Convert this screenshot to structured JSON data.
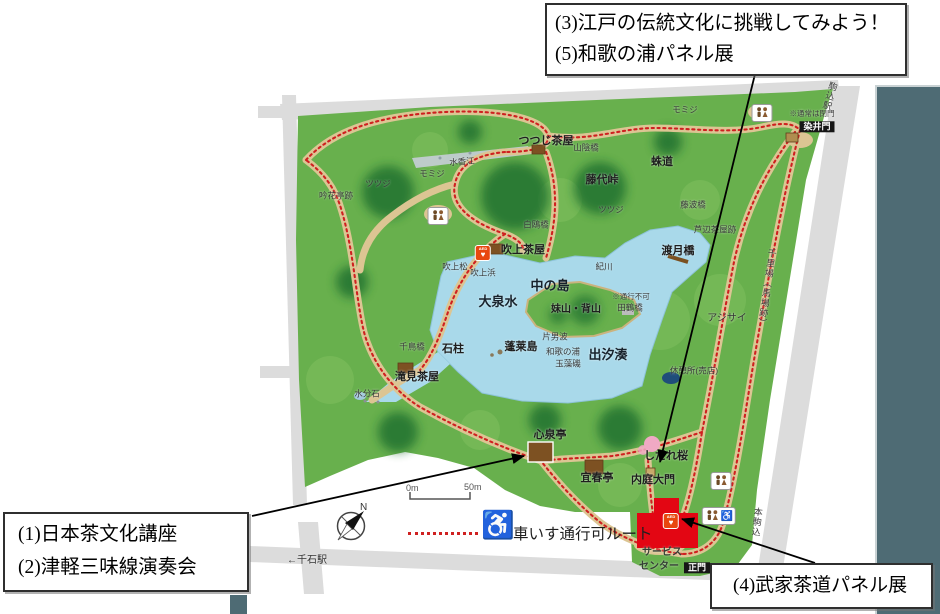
{
  "callouts": {
    "top": {
      "line1": "(3)江戸の伝統文化に挑戦してみよう！",
      "line2": "(5)和歌の浦パネル展"
    },
    "bottom_left": {
      "line1": "(1)日本茶文化講座",
      "line2": "(2)津軽三味線演奏会"
    },
    "bottom_right": {
      "line1": "(4)武家茶道パネル展"
    }
  },
  "legend": {
    "route_label": "車いす通行可ルート",
    "scale_start": "0m",
    "scale_end": "50m",
    "compass_north": "N"
  },
  "colors": {
    "park_green": "#68b04d",
    "forest_dark_green": "#1d6e2d",
    "lake_blue": "#a9d9ea",
    "path_tan": "#dcc593",
    "route_red": "#cf2020",
    "road_gray": "#dcdcdc",
    "service_center_red": "#e30613",
    "background_panel_slate": "#4e6b74",
    "gate_label_bg": "#161616"
  },
  "icon_glyphs": [
    {
      "name": "toilet-icon",
      "glyph": "🚻"
    },
    {
      "name": "toilet-accessible-icon",
      "glyph": "🚻♿"
    },
    {
      "name": "aed-icon",
      "glyph": "AED ♥"
    },
    {
      "name": "wheelchair-icon",
      "glyph": "♿"
    },
    {
      "name": "compass-icon",
      "glyph": "N"
    }
  ],
  "map": {
    "labels": [
      {
        "t": "つつじ茶屋",
        "x": 546,
        "y": 142,
        "s": "l"
      },
      {
        "t": "山陰橋",
        "x": 586,
        "y": 148,
        "s": "s"
      },
      {
        "t": "蛛道",
        "x": 662,
        "y": 163,
        "s": "l"
      },
      {
        "t": "藤代峠",
        "x": 602,
        "y": 181,
        "s": "l"
      },
      {
        "t": "ツツジ",
        "x": 611,
        "y": 210,
        "s": "s"
      },
      {
        "t": "白鴎橋",
        "x": 536,
        "y": 225,
        "s": "s"
      },
      {
        "t": "モミジ",
        "x": 432,
        "y": 174,
        "s": "s"
      },
      {
        "t": "モミジ",
        "x": 685,
        "y": 110,
        "s": "s"
      },
      {
        "t": "水香江",
        "x": 462,
        "y": 162,
        "s": "s",
        "r": -4
      },
      {
        "t": "ツツジ",
        "x": 378,
        "y": 184,
        "s": "s"
      },
      {
        "t": "吟花亭跡",
        "x": 336,
        "y": 196,
        "s": "s"
      },
      {
        "t": "吹上茶屋",
        "x": 523,
        "y": 251,
        "s": "l"
      },
      {
        "t": "吹上松",
        "x": 455,
        "y": 267,
        "s": "s"
      },
      {
        "t": "吹上浜",
        "x": 483,
        "y": 273,
        "s": "s"
      },
      {
        "t": "紀川",
        "x": 604,
        "y": 267,
        "s": "s"
      },
      {
        "t": "中の島",
        "x": 550,
        "y": 286,
        "s": "xl"
      },
      {
        "t": "大泉水",
        "x": 498,
        "y": 302,
        "s": "xl"
      },
      {
        "t": "妹山・背山",
        "x": 576,
        "y": 310,
        "s": "l2"
      },
      {
        "t": "※通行不可",
        "x": 631,
        "y": 297,
        "s": "xs"
      },
      {
        "t": "田鶴橋",
        "x": 630,
        "y": 308,
        "s": "s"
      },
      {
        "t": "渡月橋",
        "x": 678,
        "y": 252,
        "s": "l"
      },
      {
        "t": "藤波橋",
        "x": 693,
        "y": 205,
        "s": "s"
      },
      {
        "t": "芦辺茶屋跡",
        "x": 715,
        "y": 230,
        "s": "s"
      },
      {
        "t": "蓬莱島",
        "x": 521,
        "y": 348,
        "s": "l"
      },
      {
        "t": "片男波",
        "x": 555,
        "y": 337,
        "s": "s"
      },
      {
        "t": "和歌の浦",
        "x": 563,
        "y": 352,
        "s": "s"
      },
      {
        "t": "玉藻磯",
        "x": 568,
        "y": 364,
        "s": "s"
      },
      {
        "t": "出汐湊",
        "x": 608,
        "y": 355,
        "s": "xl"
      },
      {
        "t": "石柱",
        "x": 453,
        "y": 350,
        "s": "l"
      },
      {
        "t": "千鳥橋",
        "x": 412,
        "y": 347,
        "s": "s"
      },
      {
        "t": "滝見茶屋",
        "x": 417,
        "y": 378,
        "s": "l"
      },
      {
        "t": "水分石",
        "x": 367,
        "y": 394,
        "s": "s"
      },
      {
        "t": "休憩所(売店)",
        "x": 694,
        "y": 371,
        "s": "s"
      },
      {
        "t": "アジサイ",
        "x": 727,
        "y": 319,
        "s": "m"
      },
      {
        "t": "心泉亭",
        "x": 550,
        "y": 436,
        "s": "l"
      },
      {
        "t": "宜春亭",
        "x": 597,
        "y": 479,
        "s": "l"
      },
      {
        "t": "内庭大門",
        "x": 653,
        "y": 481,
        "s": "l"
      },
      {
        "t": "しだれ桜",
        "x": 666,
        "y": 457,
        "s": "l"
      },
      {
        "t": "サービス",
        "x": 662,
        "y": 553,
        "s": "m2"
      },
      {
        "t": "センター",
        "x": 659,
        "y": 567,
        "s": "m2"
      },
      {
        "t": "正門",
        "x": 697,
        "y": 568,
        "s": "chip"
      },
      {
        "t": "染井門",
        "x": 817,
        "y": 127,
        "s": "chip"
      },
      {
        "t": "※通常は閉門",
        "x": 812,
        "y": 114,
        "s": "xs"
      },
      {
        "t": "←千石駅",
        "x": 307,
        "y": 561,
        "s": "m"
      },
      {
        "t": "駒込駅",
        "x": 829,
        "y": 96,
        "s": "v",
        "r": 16
      },
      {
        "t": "千里場（馬場跡）",
        "x": 766,
        "y": 288,
        "s": "v",
        "r": 8
      },
      {
        "t": "本駒込",
        "x": 756,
        "y": 522,
        "s": "v",
        "r": 6
      }
    ],
    "icons": [
      {
        "type": "toilet",
        "x": 438,
        "y": 216
      },
      {
        "type": "toilet",
        "x": 762,
        "y": 113
      },
      {
        "type": "toilet",
        "x": 721,
        "y": 481
      },
      {
        "type": "toilet-accessible",
        "x": 719,
        "y": 516
      },
      {
        "type": "aed",
        "x": 483,
        "y": 253
      },
      {
        "type": "aed",
        "x": 671,
        "y": 521
      }
    ]
  }
}
